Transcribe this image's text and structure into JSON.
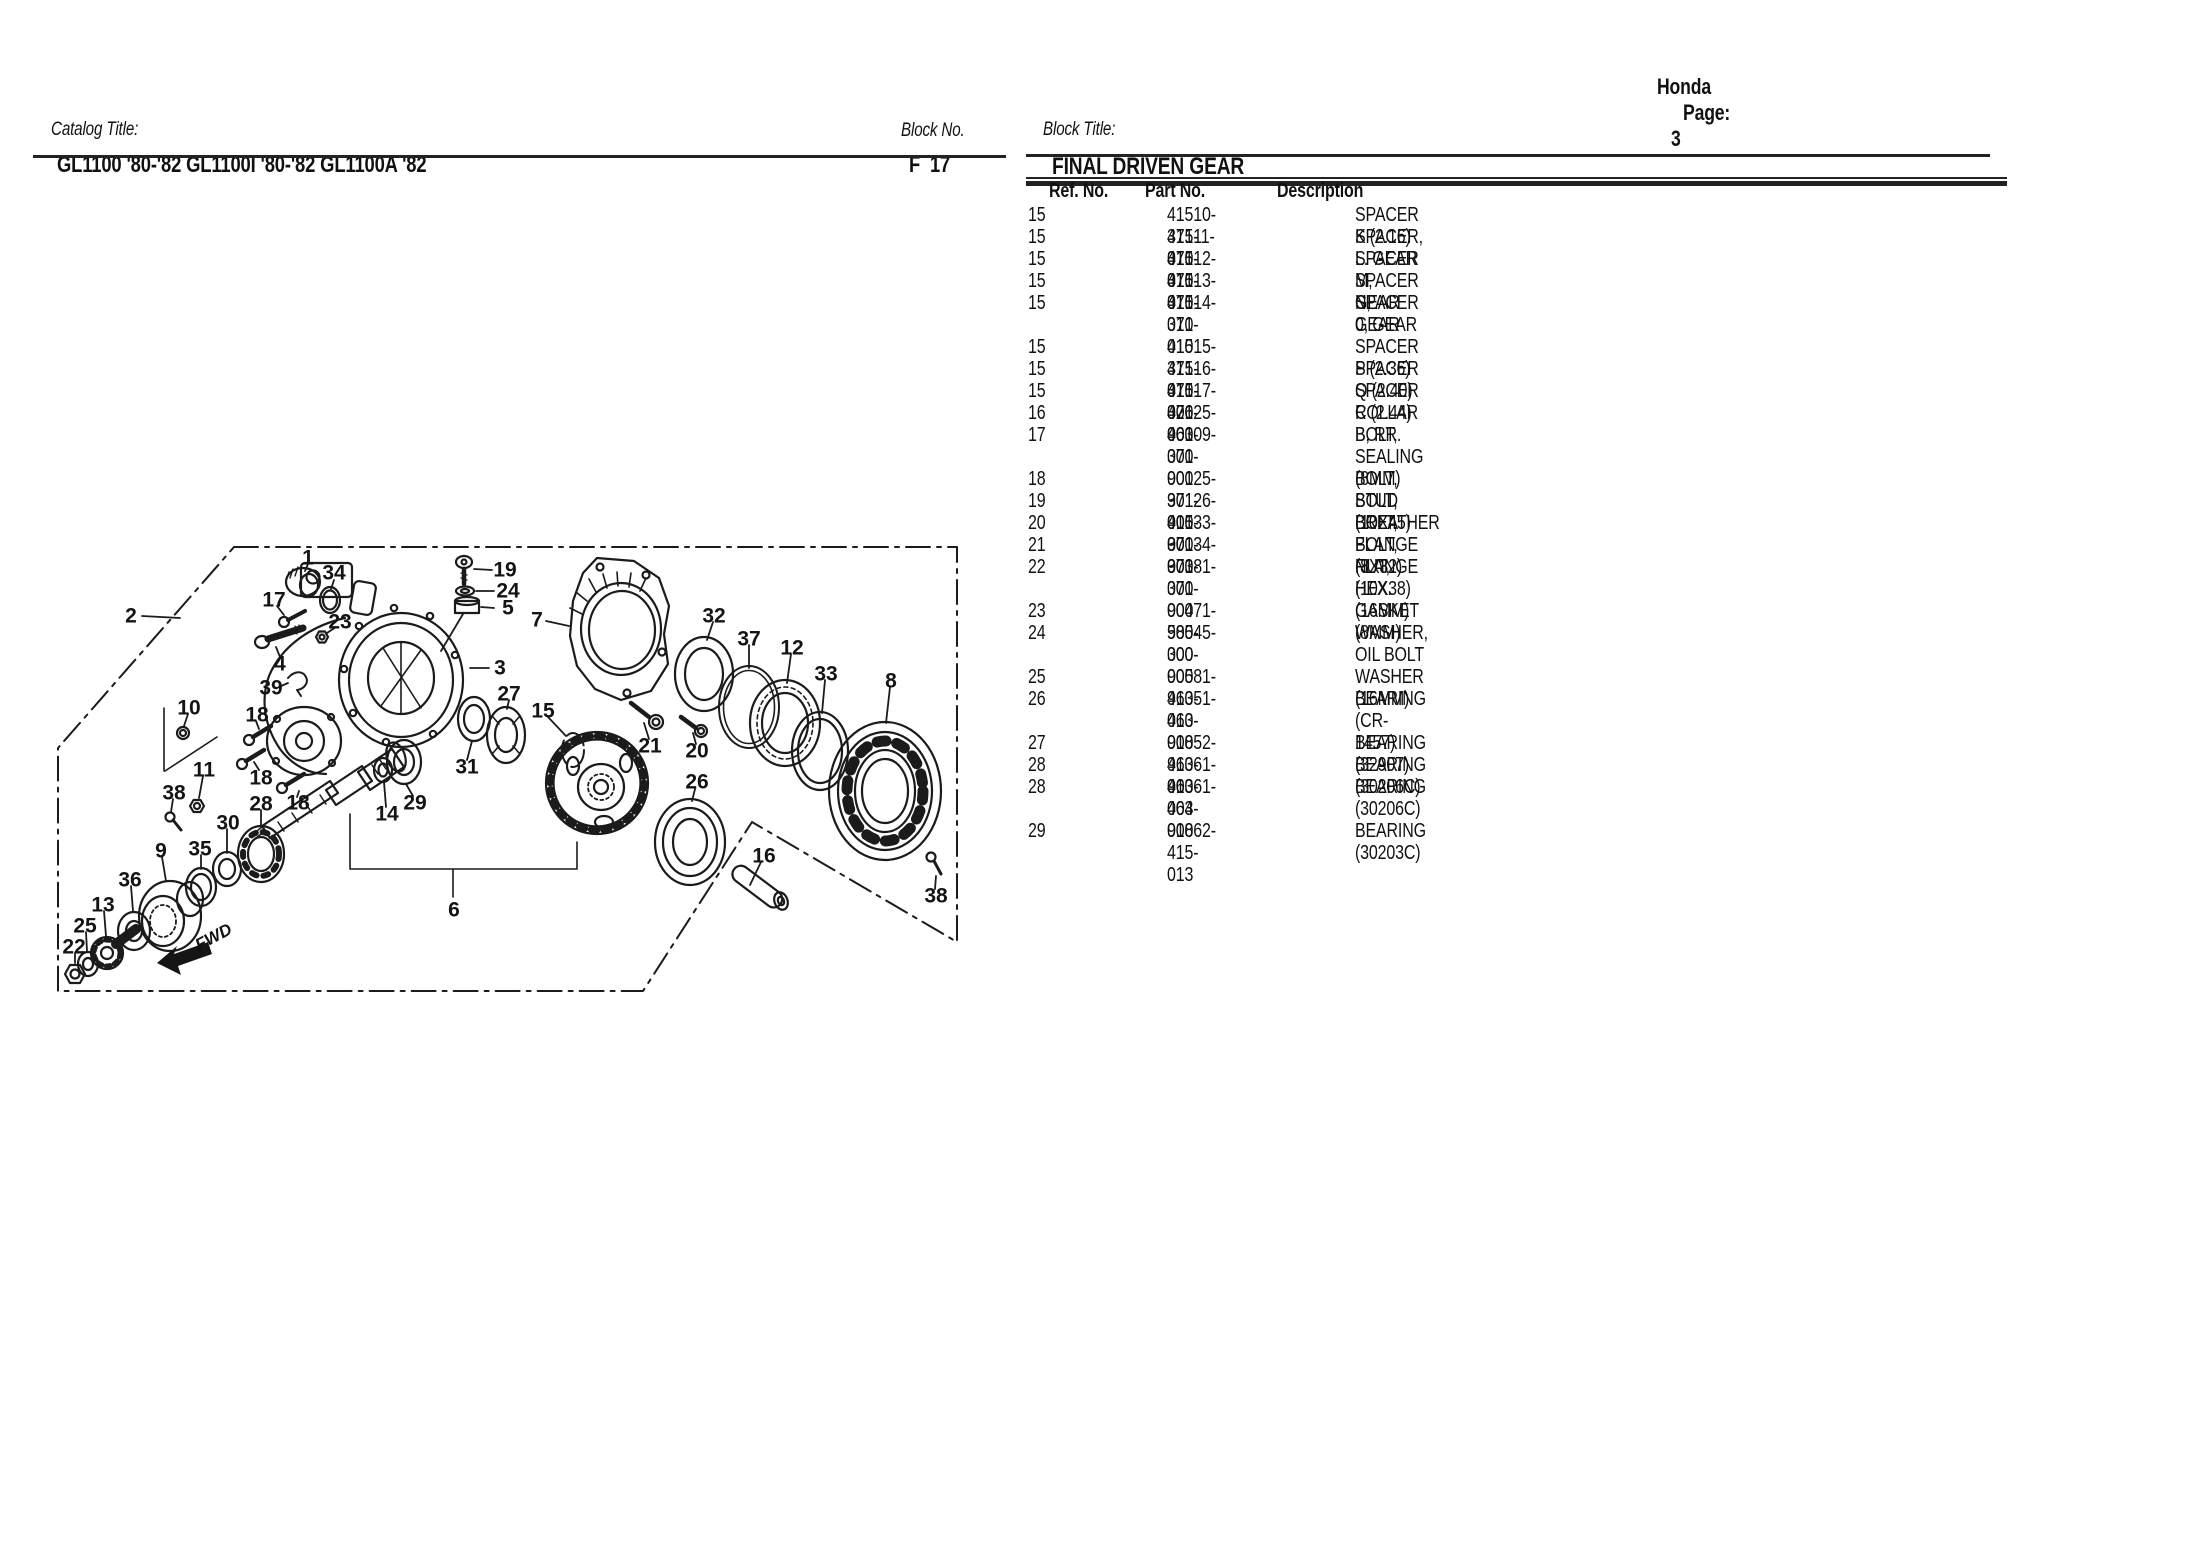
{
  "page": {
    "brand": "Honda",
    "page_label": "Page:",
    "page_number": "3"
  },
  "header": {
    "catalog_label": "Catalog Title:",
    "catalog_title": "GL1100 '80-'82 GL1100I '80-'82 GL1100A '82",
    "block_no_label": "Block No.",
    "block_no": "F  17",
    "block_title_label": "Block Title:",
    "block_title": "FINAL DRIVEN GEAR"
  },
  "table": {
    "columns": [
      "Ref. No.",
      "Part No.",
      "Description"
    ],
    "groups": [
      [
        [
          "15",
          "41510-371-010",
          "SPACER K (2.16)"
        ],
        [
          "15",
          "41511-371-010",
          "SPACER, L. GEAR"
        ],
        [
          "15",
          "41512-371-010",
          "SPACER M, GEAR"
        ],
        [
          "15",
          "41513-371-010",
          "SPACER N, GEAR"
        ],
        [
          "15",
          "41514-371-010",
          "SPACER 0, GEAR"
        ]
      ],
      [
        [
          "15",
          "41515-371-010",
          "SPACER P (2.36)"
        ],
        [
          "15",
          "41516-371-000",
          "SPACER Q (2.40)"
        ],
        [
          "15",
          "41517-371-000",
          "SPACER R (2.44)"
        ],
        [
          "16",
          "42625-463-000",
          "COLLAR B, RR."
        ],
        [
          "17",
          "90109-371-000",
          "BOLT, SEALING (8MM)"
        ]
      ],
      [
        [
          "18",
          "90125-371-000",
          "BOLT, STUD (10X45)"
        ],
        [
          "19",
          "90126-415-000",
          "BOLT, BREATHER"
        ],
        [
          "20",
          "90133-371-000",
          "BOLT, FLANGE (8X32)"
        ],
        [
          "21",
          "90134-371-000",
          "BOLT, FLANGE (10X38)"
        ],
        [
          "22",
          "90381-371-000",
          "NUT, HEX. (16MM)"
        ]
      ],
      [
        [
          "23",
          "90471-580-000",
          "GASKET (8MM)"
        ],
        [
          "24",
          "90545-300-000",
          "WASHER, OIL BOLT"
        ]
      ],
      [
        [
          "25",
          "90581-463-010",
          "WASHER (16MM)"
        ],
        [
          "26",
          "91051-463-008",
          "BEARING (CR-1457)"
        ]
      ],
      [
        [
          "27",
          "91052-463-003",
          "BEARING (32907)"
        ],
        [
          "28",
          "91061-463-004",
          "BEARING (30206C)"
        ],
        [
          "28",
          "91061-463-008",
          "BEARING (30206C)"
        ]
      ],
      [
        [
          "29",
          "91062-415-013",
          "BEARING (30203C)"
        ]
      ]
    ]
  },
  "diagram": {
    "fwd_label": "FWD",
    "labels": [
      {
        "t": "1",
        "x": 308,
        "y": 558
      },
      {
        "t": "34",
        "x": 334,
        "y": 573
      },
      {
        "t": "17",
        "x": 274,
        "y": 600
      },
      {
        "t": "2",
        "x": 131,
        "y": 616
      },
      {
        "t": "19",
        "x": 505,
        "y": 570
      },
      {
        "t": "24",
        "x": 508,
        "y": 591
      },
      {
        "t": "5",
        "x": 508,
        "y": 608
      },
      {
        "t": "7",
        "x": 537,
        "y": 620
      },
      {
        "t": "23",
        "x": 340,
        "y": 622
      },
      {
        "t": "4",
        "x": 280,
        "y": 664
      },
      {
        "t": "3",
        "x": 500,
        "y": 668
      },
      {
        "t": "39",
        "x": 271,
        "y": 688
      },
      {
        "t": "27",
        "x": 509,
        "y": 694
      },
      {
        "t": "10",
        "x": 189,
        "y": 708
      },
      {
        "t": "15",
        "x": 543,
        "y": 711
      },
      {
        "t": "18",
        "x": 257,
        "y": 715
      },
      {
        "t": "32",
        "x": 714,
        "y": 616
      },
      {
        "t": "37",
        "x": 749,
        "y": 639
      },
      {
        "t": "12",
        "x": 792,
        "y": 648
      },
      {
        "t": "33",
        "x": 826,
        "y": 674
      },
      {
        "t": "8",
        "x": 891,
        "y": 681
      },
      {
        "t": "11",
        "x": 204,
        "y": 770
      },
      {
        "t": "18",
        "x": 261,
        "y": 778
      },
      {
        "t": "38",
        "x": 174,
        "y": 793
      },
      {
        "t": "28",
        "x": 261,
        "y": 804
      },
      {
        "t": "18",
        "x": 298,
        "y": 803
      },
      {
        "t": "29",
        "x": 415,
        "y": 803
      },
      {
        "t": "14",
        "x": 387,
        "y": 814
      },
      {
        "t": "30",
        "x": 228,
        "y": 823
      },
      {
        "t": "21",
        "x": 650,
        "y": 746
      },
      {
        "t": "20",
        "x": 697,
        "y": 751
      },
      {
        "t": "26",
        "x": 697,
        "y": 782
      },
      {
        "t": "31",
        "x": 467,
        "y": 767
      },
      {
        "t": "35",
        "x": 200,
        "y": 849
      },
      {
        "t": "9",
        "x": 161,
        "y": 851
      },
      {
        "t": "16",
        "x": 764,
        "y": 856
      },
      {
        "t": "36",
        "x": 130,
        "y": 880
      },
      {
        "t": "13",
        "x": 103,
        "y": 905
      },
      {
        "t": "25",
        "x": 85,
        "y": 926
      },
      {
        "t": "22",
        "x": 74,
        "y": 947
      },
      {
        "t": "38",
        "x": 936,
        "y": 896
      },
      {
        "t": "6",
        "x": 454,
        "y": 910
      }
    ]
  }
}
